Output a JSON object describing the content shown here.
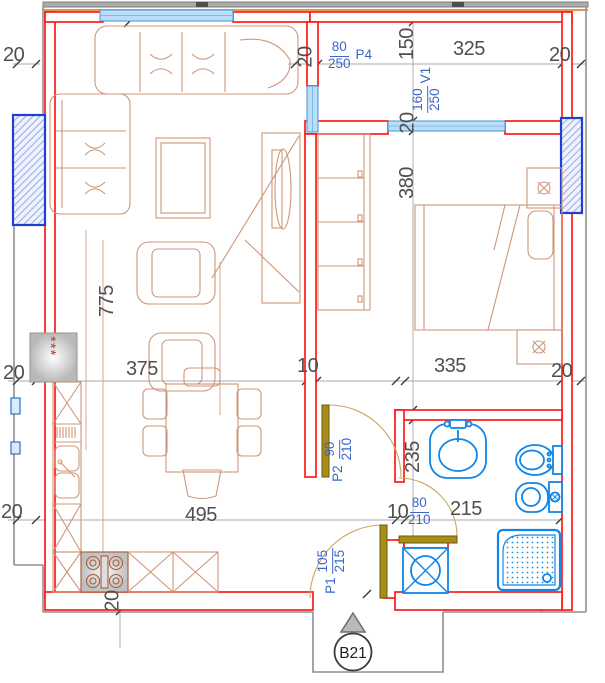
{
  "dimensions_cm": {
    "wall_thickness": "20",
    "partition_thickness": "10",
    "living_room_height": "775",
    "living_room_width_upper": "375",
    "living_room_width_lower": "495",
    "balcony_depth": "150",
    "balcony_width": "325",
    "bedroom_depth": "380",
    "bedroom_width": "335",
    "bathroom_depth": "235",
    "bathroom_width": "215"
  },
  "openings": {
    "balcony_door_p4": {
      "width": "80",
      "height": "250",
      "name": "P4"
    },
    "bedroom_window_v1": {
      "width": "160",
      "height": "250",
      "name": "V1"
    },
    "interior_door_p2": {
      "width": "90",
      "height": "210",
      "name": "P2"
    },
    "entrance_door_p1": {
      "width": "105",
      "height": "215",
      "name": "P1"
    },
    "bathroom_door": {
      "width": "80",
      "height": "210"
    }
  },
  "stamp": {
    "unit_label": "B21"
  },
  "symbols": {
    "stove_marks": "***"
  },
  "colors": {
    "wall": "#ff1a1a",
    "window_fill": "#badef5",
    "window_frame": "#4a90d9",
    "column_border": "#2040cf",
    "fixture_blue": "#0f86e8",
    "door_leaf": "#a88c1a",
    "furniture_tan": "#cf9678",
    "dimension_text": "#4f4f4f",
    "opening_label_blue": "#3a66c8",
    "boundary_gray": "#8f8f8f",
    "accent_orange": "#dd8a33"
  }
}
